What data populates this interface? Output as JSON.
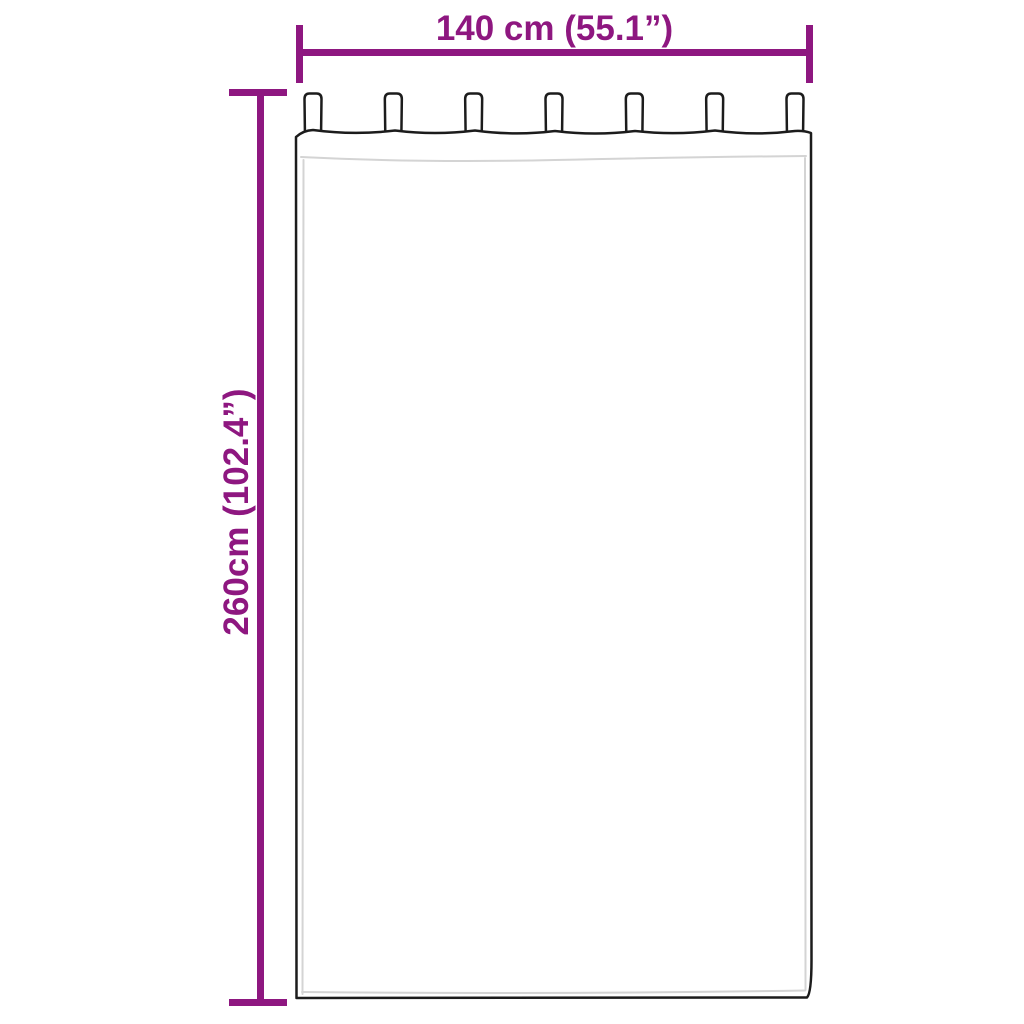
{
  "diagram": {
    "width_dimension": {
      "label": "140 cm (55.1”)"
    },
    "height_dimension": {
      "label": "260cm (102.4”)"
    },
    "curtain": {
      "tab_count": 7
    }
  },
  "colors": {
    "dimension_accent": "#8e1780",
    "outline": "#1c1c1c",
    "seam": "#d4d4d4",
    "background": "#ffffff"
  }
}
